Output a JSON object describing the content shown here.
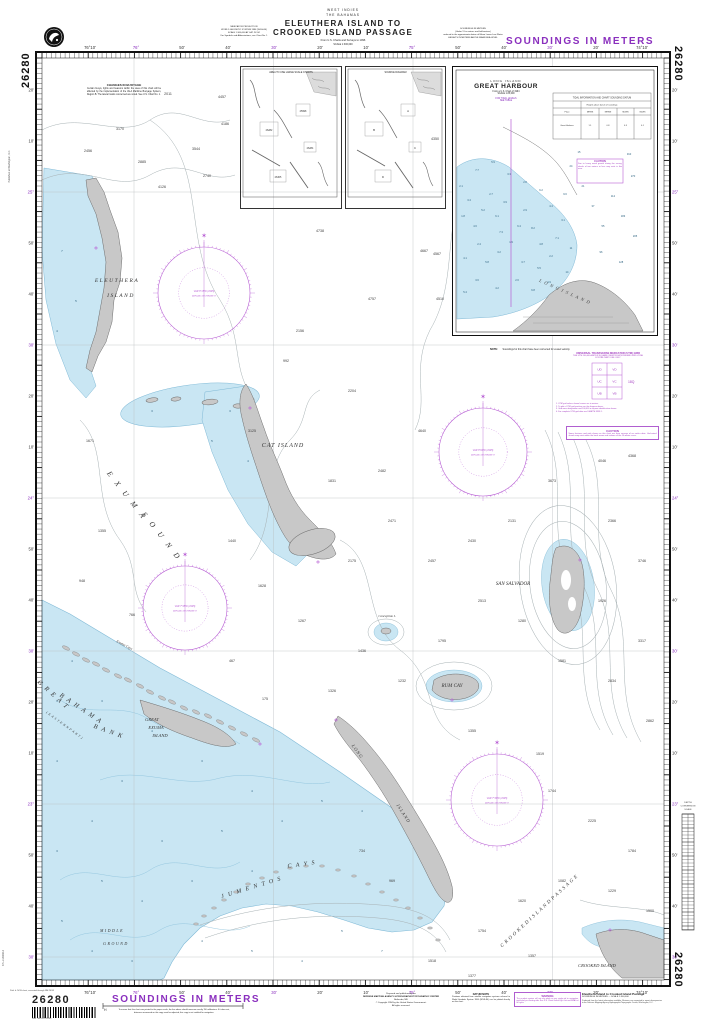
{
  "chart_no": "26280",
  "colors": {
    "magenta": "#8a2fbe",
    "rose": "#b85fd4",
    "water": "#c9e6f3",
    "water_edge": "#7fb9d6",
    "land": "#c8c8c8",
    "land_edge": "#6d6d6d",
    "contour": "#a7b1b4",
    "ink": "#222222"
  },
  "header": {
    "region": "WEST INDIES",
    "country": "THE BAHAMAS",
    "title1": "ELEUTHERA ISLAND TO",
    "title2": "CROOKED ISLAND PASSAGE",
    "source": "From U.S. Charts and Surveys to 1996",
    "scale_note": "SCALE 1:300,000",
    "projection_block": [
      "MERCATOR PROJECTION",
      "WORLD GEODETIC SYSTEM 1984 (WGS-84)",
      "SCALE 1:300,000 AT LAT. 24°00'",
      "For Symbols and Abbreviations, see Chart No. 1"
    ],
    "soundings_block": [
      "SOUNDINGS IN METERS",
      "(Under 11 in metres and half-metres)",
      "reduced to the approximate datum of Mean Lower Low Water",
      "HEIGHTS IN METERS ABOVE MEAN SEA LEVEL"
    ],
    "soundings_banner": "SOUNDINGS IN METERS"
  },
  "notes": {
    "buoyage_title": "CHANGES IN BUOYAGE",
    "buoyage_body": "Certain buoys, lights and beacons within the area of this chart will be affected by the implementation of the IALA Maritime Buoyage System, Region B. The lateral marks concerned are noted. See U.S. Chart No. 1.",
    "utm": [
      "UNIVERSAL TRANSVERSE MERCATOR (UTM) GRID",
      "THE UTM 100,000-METER SQUARE IDENTIFICATIONS AND GRID ZONE",
      "FOR MILITARY USE ONLY"
    ],
    "utm_zone": "18Q",
    "utm_footnotes": [
      "1. UTM grid values shown hereon are in meters.",
      "2. To plot a UTM grid position use the diagram above.",
      "3. Grid zone designation and 100,000 m square identification shown.",
      "4. For complete UTM grid data see DMA TM 8358.1."
    ],
    "caution_title": "CAUTION",
    "caution_body": "Some features and aids shown on this chart are from surveys of an earlier date. Uncharted shoals may exist within the bank areas and inshore of the 10-meter curve.",
    "gh_note_title": "NOTE:",
    "gh_note_body": "Soundings for this chart have been corrected for vessel velocity."
  },
  "inset_gh": {
    "place": "LONG ISLAND",
    "name": "GREAT HARBOUR",
    "from": "From a U.S. Chart of 1994",
    "scale": "SCALE 1:25,000",
    "mag1": "FOR TIDAL LEVELS",
    "mag2": "SEE TABLE",
    "caution_title": "CAUTION",
    "caution_body": "Due to heavy weed growth during the survey, shoals of two meters or less may exist in this area.",
    "label": "L O N G   I S L A N D",
    "table_title": "TIDAL INFORMATION AND CHART SOUNDING DATUM",
    "table_sub": "Heights above datum of soundings",
    "table_cols": [
      "Place",
      "MHWS",
      "MHWN",
      "MLWN",
      "MLWS"
    ],
    "table_row": [
      "Great Harbour",
      "1.1",
      "0.8",
      "0.3",
      "0.1"
    ],
    "soundings": [
      [
        8,
        120,
        "2.1"
      ],
      [
        16,
        134,
        "3.4"
      ],
      [
        10,
        150,
        "1.8"
      ],
      [
        22,
        160,
        "4.6"
      ],
      [
        30,
        144,
        "5.2"
      ],
      [
        38,
        128,
        "2.7"
      ],
      [
        44,
        150,
        "6.1"
      ],
      [
        52,
        136,
        "3.9"
      ],
      [
        48,
        166,
        "7.3"
      ],
      [
        26,
        178,
        "2.4"
      ],
      [
        12,
        192,
        "4.1"
      ],
      [
        34,
        196,
        "5.8"
      ],
      [
        46,
        186,
        "3.2"
      ],
      [
        58,
        176,
        "1.9"
      ],
      [
        66,
        160,
        "6.4"
      ],
      [
        72,
        144,
        "2.9"
      ],
      [
        80,
        162,
        "8.2"
      ],
      [
        88,
        178,
        "4.8"
      ],
      [
        70,
        196,
        "3.7"
      ],
      [
        86,
        202,
        "5.5"
      ],
      [
        98,
        190,
        "2.2"
      ],
      [
        104,
        172,
        "7.1"
      ],
      [
        110,
        154,
        "3.1"
      ],
      [
        98,
        140,
        "4.4"
      ],
      [
        112,
        128,
        "9.6"
      ],
      [
        118,
        182,
        "11"
      ],
      [
        114,
        206,
        "14"
      ],
      [
        64,
        214,
        "2.6"
      ],
      [
        44,
        222,
        "4.2"
      ],
      [
        24,
        214,
        "3.6"
      ],
      [
        12,
        226,
        "5.4"
      ],
      [
        80,
        224,
        "6.8"
      ],
      [
        96,
        216,
        "4.9"
      ],
      [
        130,
        120,
        "21"
      ],
      [
        140,
        140,
        "37"
      ],
      [
        150,
        160,
        "55"
      ],
      [
        160,
        130,
        "112"
      ],
      [
        170,
        150,
        "183"
      ],
      [
        180,
        110,
        "270"
      ],
      [
        176,
        88,
        "310"
      ],
      [
        118,
        100,
        "24"
      ],
      [
        126,
        86,
        "15"
      ],
      [
        56,
        108,
        "3.3"
      ],
      [
        72,
        116,
        "2.8"
      ],
      [
        88,
        124,
        "6.2"
      ],
      [
        40,
        96,
        "5.9"
      ],
      [
        24,
        104,
        "7.7"
      ],
      [
        148,
        186,
        "96"
      ],
      [
        168,
        196,
        "128"
      ],
      [
        182,
        170,
        "205"
      ]
    ]
  },
  "index_insets": {
    "left_caption": "AREA TO USE LARGE SCALE CHARTS",
    "right_caption": "SOURCE DIAGRAM",
    "left_tags": [
      "25998",
      "26282",
      "26284",
      "26305"
    ],
    "right_tags": [
      "A",
      "B",
      "C",
      "D"
    ]
  },
  "scalebar": {
    "title": [
      "DEPTH",
      "CONVERSION",
      "SCALE"
    ]
  },
  "frame": {
    "left": 36,
    "right": 670,
    "top": 52,
    "bottom": 986,
    "ileft": 42,
    "iright": 664,
    "itop": 58,
    "ibottom": 980,
    "minx": 4.62,
    "miny": 5.12
  },
  "graticule": {
    "v": [
      134,
      273.5,
      413,
      552.5
    ],
    "h": [
      192,
      345,
      498,
      651,
      804,
      957
    ]
  },
  "lon_labels": [
    [
      90,
      "76°10'",
      0
    ],
    [
      136,
      "76°",
      1
    ],
    [
      182,
      "50'",
      0
    ],
    [
      228,
      "40'",
      0
    ],
    [
      274,
      "30'",
      1
    ],
    [
      320,
      "20'",
      0
    ],
    [
      366,
      "10'",
      0
    ],
    [
      412,
      "75°",
      1
    ],
    [
      458,
      "50'",
      0
    ],
    [
      504,
      "40'",
      0
    ],
    [
      550,
      "30'",
      1
    ],
    [
      596,
      "20'",
      0
    ],
    [
      642,
      "74°10'",
      0
    ]
  ],
  "lat_labels": [
    [
      90,
      "20'",
      0
    ],
    [
      141,
      "10'",
      0
    ],
    [
      192,
      "25°",
      1
    ],
    [
      243,
      "50'",
      0
    ],
    [
      294,
      "40'",
      0
    ],
    [
      345,
      "30'",
      1
    ],
    [
      396,
      "20'",
      0
    ],
    [
      447,
      "10'",
      0
    ],
    [
      498,
      "24°",
      1
    ],
    [
      549,
      "50'",
      0
    ],
    [
      600,
      "40'",
      0
    ],
    [
      651,
      "30'",
      1
    ],
    [
      702,
      "20'",
      0
    ],
    [
      753,
      "10'",
      0
    ],
    [
      804,
      "23°",
      1
    ],
    [
      855,
      "50'",
      0
    ],
    [
      906,
      "40'",
      0
    ],
    [
      957,
      "30'",
      1
    ]
  ],
  "map_labels": [
    {
      "t": "ELEUTHERA",
      "x": 117,
      "y": 282,
      "fs": 5.5,
      "it": 1,
      "ls": 1.5
    },
    {
      "t": "ISLAND",
      "x": 121,
      "y": 297,
      "fs": 5.5,
      "it": 1,
      "ls": 1.5
    },
    {
      "t": "E X U M A",
      "x": 125,
      "y": 497,
      "fs": 7.5,
      "it": 1,
      "ls": 3,
      "rot": 52
    },
    {
      "t": "S O U N D",
      "x": 160,
      "y": 538,
      "fs": 7.5,
      "it": 1,
      "ls": 3,
      "rot": 52
    },
    {
      "t": "CAT ISLAND",
      "x": 283,
      "y": 447,
      "fs": 6,
      "it": 1,
      "ls": 1
    },
    {
      "t": "G R E A T",
      "x": 52,
      "y": 696,
      "fs": 6.5,
      "it": 1,
      "ls": 1.5,
      "rot": 42
    },
    {
      "t": "B A H A M A",
      "x": 80,
      "y": 710,
      "fs": 6.5,
      "it": 1,
      "ls": 1.5,
      "rot": 34
    },
    {
      "t": "B A N K",
      "x": 108,
      "y": 733,
      "fs": 6.5,
      "it": 1,
      "ls": 1.5,
      "rot": 20
    },
    {
      "t": "( E A S T E R N   P A R T )",
      "x": 64,
      "y": 726,
      "fs": 3.2,
      "it": 1,
      "ls": 0.5,
      "rot": 36
    },
    {
      "t": "GREAT",
      "x": 152,
      "y": 721,
      "fs": 4.5,
      "it": 1
    },
    {
      "t": "EXUMA",
      "x": 156,
      "y": 729,
      "fs": 4.5,
      "it": 1
    },
    {
      "t": "ISLAND",
      "x": 160,
      "y": 737,
      "fs": 4.5,
      "it": 1
    },
    {
      "t": "L O N G",
      "x": 356,
      "y": 752,
      "fs": 4.5,
      "it": 1,
      "rot": 54
    },
    {
      "t": "I S L A N D",
      "x": 402,
      "y": 814,
      "fs": 4.5,
      "it": 1,
      "rot": 57
    },
    {
      "t": "SAN SALVADOR",
      "x": 513,
      "y": 585,
      "fs": 5,
      "it": 1
    },
    {
      "t": "RUM CAY",
      "x": 452,
      "y": 687,
      "fs": 5,
      "it": 1
    },
    {
      "t": "Conception I.",
      "x": 387,
      "y": 617,
      "fs": 3.2,
      "it": 1
    },
    {
      "t": "J U M E N T O S",
      "x": 252,
      "y": 889,
      "fs": 6,
      "it": 1,
      "ls": 1.5,
      "rot": -17
    },
    {
      "t": "C A Y S",
      "x": 302,
      "y": 866,
      "fs": 6,
      "it": 1,
      "ls": 1.5,
      "rot": -8
    },
    {
      "t": "C R O O K E D   I S L A N D   P A S S A G E",
      "x": 540,
      "y": 912,
      "fs": 5,
      "it": 1,
      "ls": 0.5,
      "rot": -43
    },
    {
      "t": "CROOKED ISLAND",
      "x": 597,
      "y": 967,
      "fs": 4.5,
      "it": 1
    },
    {
      "t": "MIDDLE",
      "x": 112,
      "y": 932,
      "fs": 4,
      "it": 1,
      "ls": 1.5
    },
    {
      "t": "GROUND",
      "x": 116,
      "y": 945,
      "fs": 4,
      "it": 1,
      "ls": 1.5
    },
    {
      "t": "Exuma Cays",
      "x": 124,
      "y": 646,
      "fs": 3.5,
      "it": 1,
      "rot": 28
    }
  ],
  "roses": [
    {
      "cx": 204,
      "cy": 293,
      "r": 46,
      "l1": "VAR 8°15'W (1995)",
      "l2": "ANNUAL DECREASE 8'"
    },
    {
      "cx": 483,
      "cy": 452,
      "r": 44,
      "l1": "VAR 8°00'W (1995)",
      "l2": "ANNUAL DECREASE 8'"
    },
    {
      "cx": 185,
      "cy": 608,
      "r": 42,
      "l1": "VAR 7°45'W (1995)",
      "l2": "ANNUAL DECREASE 8'"
    },
    {
      "cx": 497,
      "cy": 800,
      "r": 46,
      "l1": "VAR 7°30'W (1995)",
      "l2": "ANNUAL DECREASE 8'"
    }
  ],
  "deep": [
    [
      168,
      95,
      "2011"
    ],
    [
      120,
      130,
      "3170"
    ],
    [
      88,
      152,
      "2456"
    ],
    [
      142,
      163,
      "2885"
    ],
    [
      196,
      150,
      "3544"
    ],
    [
      162,
      188,
      "4126"
    ],
    [
      225,
      125,
      "4186"
    ],
    [
      207,
      177,
      "2740"
    ],
    [
      222,
      98,
      "4457"
    ],
    [
      320,
      232,
      "4738"
    ],
    [
      372,
      300,
      "4757"
    ],
    [
      424,
      252,
      "4667"
    ],
    [
      300,
      332,
      "2156"
    ],
    [
      286,
      362,
      "992"
    ],
    [
      352,
      392,
      "2204"
    ],
    [
      422,
      432,
      "4640"
    ],
    [
      382,
      472,
      "2482"
    ],
    [
      332,
      482,
      "1831"
    ],
    [
      252,
      432,
      "3125"
    ],
    [
      232,
      542,
      "1440"
    ],
    [
      262,
      587,
      "1628"
    ],
    [
      302,
      622,
      "1267"
    ],
    [
      352,
      562,
      "2175"
    ],
    [
      392,
      522,
      "2471"
    ],
    [
      432,
      562,
      "2457"
    ],
    [
      472,
      542,
      "2430"
    ],
    [
      512,
      522,
      "2131"
    ],
    [
      552,
      482,
      "3673"
    ],
    [
      602,
      462,
      "4046"
    ],
    [
      632,
      457,
      "4368"
    ],
    [
      612,
      522,
      "2366"
    ],
    [
      642,
      562,
      "3746"
    ],
    [
      602,
      602,
      "1926"
    ],
    [
      642,
      642,
      "3317"
    ],
    [
      612,
      682,
      "2834"
    ],
    [
      650,
      722,
      "2862"
    ],
    [
      562,
      662,
      "1581"
    ],
    [
      522,
      622,
      "1280"
    ],
    [
      482,
      602,
      "2513"
    ],
    [
      442,
      642,
      "1795"
    ],
    [
      402,
      682,
      "1232"
    ],
    [
      362,
      652,
      "1436"
    ],
    [
      332,
      692,
      "1326"
    ],
    [
      472,
      732,
      "1355"
    ],
    [
      540,
      755,
      "1519"
    ],
    [
      552,
      792,
      "1744"
    ],
    [
      592,
      822,
      "2225"
    ],
    [
      632,
      852,
      "1784"
    ],
    [
      612,
      892,
      "1229"
    ],
    [
      650,
      912,
      "1500"
    ],
    [
      562,
      882,
      "1082"
    ],
    [
      522,
      902,
      "1620"
    ],
    [
      482,
      932,
      "1754"
    ],
    [
      432,
      962,
      "1518"
    ],
    [
      472,
      977,
      "1377"
    ],
    [
      532,
      957,
      "1357"
    ],
    [
      362,
      852,
      "734"
    ],
    [
      392,
      882,
      "969"
    ],
    [
      435,
      140,
      "4350"
    ],
    [
      437,
      255,
      "4567"
    ],
    [
      440,
      300,
      "4510"
    ],
    [
      90,
      442,
      "1671"
    ],
    [
      102,
      532,
      "1355"
    ],
    [
      82,
      582,
      "948"
    ],
    [
      132,
      616,
      "766"
    ],
    [
      232,
      662,
      "467"
    ],
    [
      265,
      700,
      "175"
    ]
  ],
  "shallow": [
    [
      62,
      252,
      "7"
    ],
    [
      76,
      302,
      "5"
    ],
    [
      57,
      332,
      "4"
    ],
    [
      152,
      412,
      "3"
    ],
    [
      212,
      442,
      "5"
    ],
    [
      248,
      462,
      "4"
    ],
    [
      230,
      412,
      "3"
    ],
    [
      72,
      662,
      "4"
    ],
    [
      102,
      702,
      "3"
    ],
    [
      152,
      732,
      "4"
    ],
    [
      202,
      762,
      "3"
    ],
    [
      252,
      792,
      "4"
    ],
    [
      122,
      782,
      "3"
    ],
    [
      92,
      822,
      "4"
    ],
    [
      162,
      842,
      "3"
    ],
    [
      222,
      832,
      "5"
    ],
    [
      282,
      822,
      "4"
    ],
    [
      322,
      802,
      "5"
    ],
    [
      362,
      812,
      "4"
    ],
    [
      102,
      882,
      "5"
    ],
    [
      142,
      902,
      "4"
    ],
    [
      192,
      882,
      "3"
    ],
    [
      252,
      872,
      "4"
    ],
    [
      62,
      922,
      "5"
    ],
    [
      92,
      952,
      "4"
    ],
    [
      132,
      962,
      "3"
    ],
    [
      202,
      942,
      "4"
    ],
    [
      252,
      952,
      "5"
    ],
    [
      302,
      962,
      "4"
    ],
    [
      342,
      932,
      "5"
    ],
    [
      382,
      952,
      "7"
    ],
    [
      57,
      702,
      "3"
    ],
    [
      57,
      762,
      "4"
    ],
    [
      57,
      852,
      "3"
    ]
  ],
  "cays": {
    "exuma": [
      [
        66,
        648
      ],
      [
        76,
        654
      ],
      [
        86,
        660
      ],
      [
        96,
        664
      ],
      [
        106,
        670
      ],
      [
        118,
        676
      ],
      [
        128,
        680
      ],
      [
        140,
        686
      ],
      [
        150,
        692
      ],
      [
        162,
        698
      ],
      [
        172,
        702
      ],
      [
        184,
        708
      ],
      [
        196,
        712
      ],
      [
        208,
        716
      ],
      [
        220,
        722
      ],
      [
        232,
        728
      ],
      [
        244,
        734
      ],
      [
        256,
        740
      ]
    ],
    "jumentos": [
      [
        196,
        924
      ],
      [
        204,
        916
      ],
      [
        214,
        908
      ],
      [
        224,
        900
      ],
      [
        236,
        892
      ],
      [
        248,
        884
      ],
      [
        262,
        878
      ],
      [
        276,
        872
      ],
      [
        290,
        868
      ],
      [
        306,
        866
      ],
      [
        322,
        866
      ],
      [
        338,
        870
      ],
      [
        354,
        876
      ],
      [
        368,
        884
      ],
      [
        382,
        892
      ],
      [
        396,
        900
      ],
      [
        408,
        908
      ],
      [
        420,
        918
      ],
      [
        430,
        928
      ],
      [
        438,
        940
      ]
    ]
  },
  "marks": [
    [
      96,
      248
    ],
    [
      250,
      408
    ],
    [
      318,
      562
    ],
    [
      336,
      720
    ],
    [
      452,
      700
    ],
    [
      580,
      560
    ],
    [
      610,
      930
    ],
    [
      260,
      744
    ]
  ],
  "footer": {
    "banner": "SOUNDINGS IN METERS",
    "scale_check": "To ensure that this chart was printed to the proper scale, the line above should measure exactly 150 millimeters. If it does not, distances measured on this copy must be adjusted; this copy is not certified for navigation.",
    "publisher": [
      "Prepared and published by the",
      "DEFENSE MAPPING AGENCY HYDROGRAPHIC/TOPOGRAPHIC CENTER",
      "Bethesda, MD",
      "© Copyright 1994 by the United States Government.",
      "All rights reserved."
    ],
    "datum_title": "DATUM NOTE",
    "datum_body": "Positions obtained from satellite navigation systems referred to World Geodetic System 1984 (WGS-84) can be plotted directly on this chart.",
    "warning_title": "WARNING",
    "warning_body": "The prudent mariner will not rely solely on any single aid to navigation, particularly on floating aids. See U.S. Coast Guard Light List and NGA List of Lights.",
    "title_right": "Eleuthera Island to Crooked Island Passage",
    "subtitle_right": "SOUNDINGS IN METERS — SCALE 1:300,000",
    "fineprint": "Produced from the latest information available. Mariners are requested to report discrepancies to the Defense Mapping Agency Hydrographic/Topographic Center, Washington, D.C.",
    "print_note": "Prtd. fr. NOS chart, corrected through NM 26/95",
    "stock_note": "NSN 7642014176280",
    "side_note": "4PL-2-26280-3",
    "left_edge_note": "Published at Washington, D.C."
  }
}
